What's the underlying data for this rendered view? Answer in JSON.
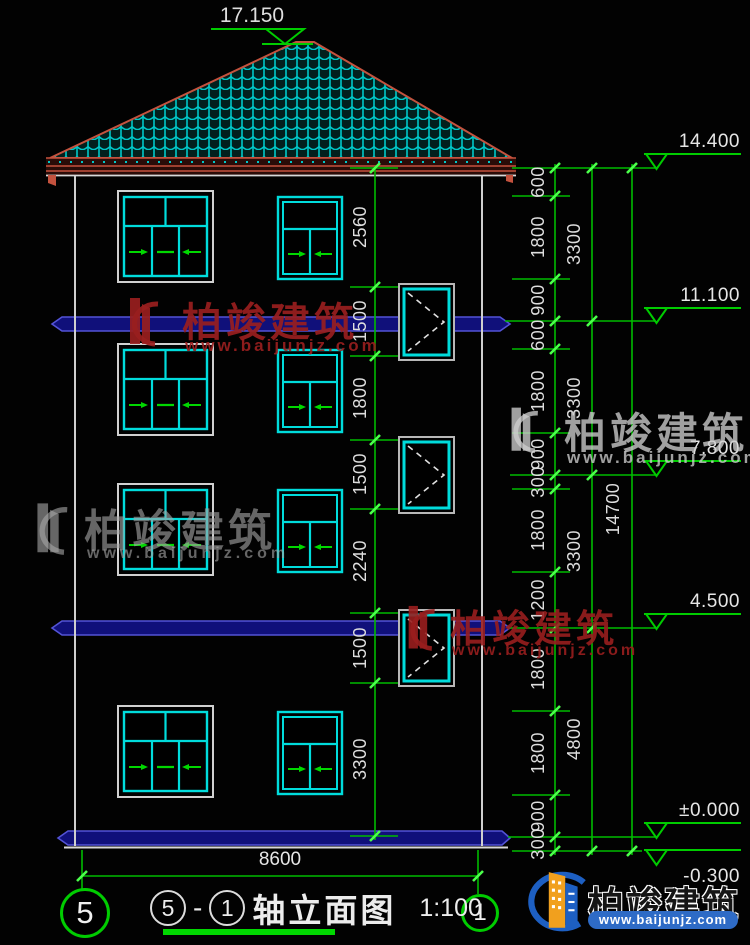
{
  "title_block": {
    "axis_from": "5",
    "separator": "-",
    "axis_to": "1",
    "name": "轴立面图",
    "scale": "1:100"
  },
  "axis_bubbles": {
    "left": "5",
    "right": "1"
  },
  "elevations": [
    "17.150",
    "14.400",
    "11.100",
    "7.800",
    "4.500",
    "±0.000",
    "-0.300"
  ],
  "dimensions": {
    "width_total": "8600",
    "right_chain": [
      "600",
      "1800",
      "900",
      "600",
      "1800",
      "900",
      "300",
      "1800",
      "1200",
      "1800",
      "1800",
      "900",
      "300"
    ],
    "right_subtotals": [
      "3300",
      "3300",
      "3300",
      "4800"
    ],
    "right_total": "14700",
    "inner_chain": [
      "2560",
      "1500",
      "1800",
      "1500",
      "2240",
      "1500",
      "3300"
    ]
  },
  "watermark": {
    "brand": "柏竣建筑",
    "url": "www.baijunjz.com"
  },
  "colors": {
    "dimension_green": "#00bb00",
    "tick_green": "#4cff4c",
    "window_cyan": "#00dcdc",
    "roof_red": "#c4523e",
    "slab_blue": "#5353d6",
    "outline_white": "#d0d0d0",
    "watermark_red": "#9c2020",
    "logo_blue": "#1d5fc2",
    "logo_orange": "#f1a01e"
  }
}
